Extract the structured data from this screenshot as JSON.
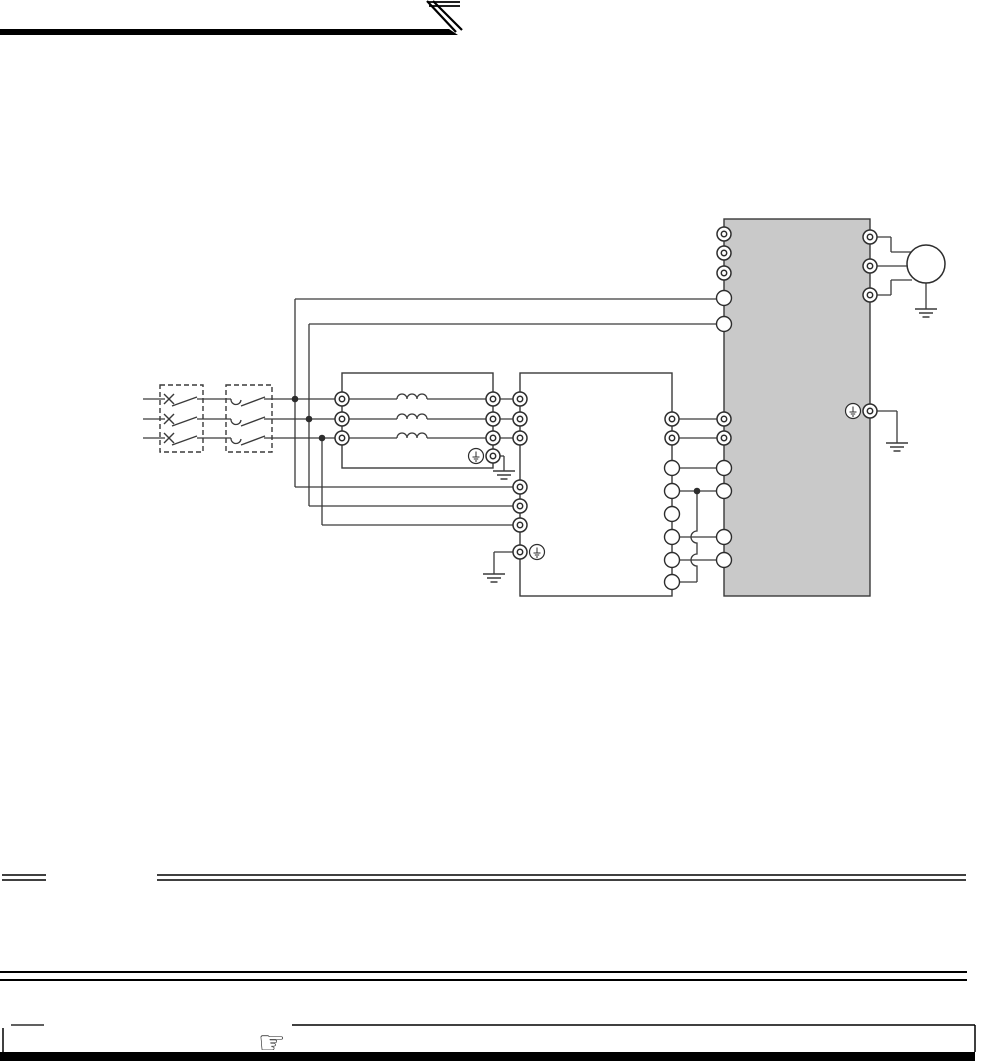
{
  "meta": {
    "description": "Scanned manual page: three-phase inverter wiring diagram (breaker, contactor, AC reactor, noise filter, inverter, motor). No rendered text on page.",
    "page_bg": "#ffffff",
    "ink": "#000000",
    "wire_color": "#3a3a3a",
    "terminal_stroke": "#2d2d2d",
    "inverter_fill": "#c9c9c9",
    "box_fill": "#ffffff"
  },
  "header": {
    "bar_points": "0,29 449,29 458,35 0,35",
    "diagonal_stripes": [
      [
        427,
        1,
        456,
        32
      ],
      [
        433,
        1,
        462,
        30
      ]
    ],
    "top_stripes": [
      [
        428,
        2,
        460,
        2
      ],
      [
        429,
        6,
        460,
        6
      ]
    ]
  },
  "schematic": {
    "phase_ys": [
      399,
      419,
      438
    ],
    "boxes": [
      {
        "name": "circuit-breaker-box",
        "dashed": true,
        "x": 160,
        "y": 385,
        "w": 43,
        "h": 67
      },
      {
        "name": "magnetic-contactor-box",
        "dashed": true,
        "x": 226,
        "y": 385,
        "w": 46,
        "h": 67
      },
      {
        "name": "ac-reactor-box",
        "dashed": false,
        "x": 342,
        "y": 373,
        "w": 151,
        "h": 95,
        "fill": "#ffffff"
      },
      {
        "name": "noise-filter-box",
        "dashed": false,
        "x": 520,
        "y": 373,
        "w": 152,
        "h": 223,
        "fill": "#ffffff"
      },
      {
        "name": "inverter-box",
        "dashed": false,
        "x": 724,
        "y": 219,
        "w": 146,
        "h": 377,
        "fill": "#c9c9c9"
      }
    ],
    "wires": [
      [
        143,
        399,
        165,
        399
      ],
      [
        197,
        399,
        231,
        399
      ],
      [
        264,
        399,
        342,
        399
      ],
      [
        342,
        399,
        397,
        399
      ],
      [
        427,
        399,
        493,
        399
      ],
      [
        493,
        399,
        520,
        399
      ],
      [
        143,
        419,
        165,
        419
      ],
      [
        197,
        419,
        231,
        419
      ],
      [
        264,
        419,
        342,
        419
      ],
      [
        342,
        419,
        397,
        419
      ],
      [
        427,
        419,
        493,
        419
      ],
      [
        493,
        419,
        520,
        419
      ],
      [
        143,
        438,
        165,
        438
      ],
      [
        197,
        438,
        231,
        438
      ],
      [
        264,
        438,
        342,
        438
      ],
      [
        342,
        438,
        397,
        438
      ],
      [
        427,
        438,
        493,
        438
      ],
      [
        493,
        438,
        520,
        438
      ],
      [
        295,
        299,
        724,
        299
      ],
      [
        309,
        324,
        724,
        324
      ],
      [
        295,
        299,
        295,
        487
      ],
      [
        295,
        487,
        520,
        487
      ],
      [
        309,
        324,
        309,
        506
      ],
      [
        309,
        506,
        520,
        506
      ],
      [
        322,
        438,
        322,
        525
      ],
      [
        322,
        525,
        520,
        525
      ],
      [
        672,
        419,
        724,
        419
      ],
      [
        672,
        438,
        724,
        438
      ],
      [
        672,
        468,
        724,
        468
      ],
      [
        672,
        491,
        724,
        491
      ],
      [
        672,
        537,
        724,
        537
      ],
      [
        672,
        560,
        724,
        560
      ],
      [
        672,
        582,
        697,
        582
      ],
      [
        870,
        237,
        891,
        237
      ],
      [
        891,
        237,
        891,
        252
      ],
      [
        891,
        252,
        912,
        252
      ],
      [
        870,
        266,
        912,
        266
      ],
      [
        870,
        295,
        891,
        295
      ],
      [
        891,
        295,
        891,
        280
      ],
      [
        891,
        280,
        912,
        280
      ],
      [
        926,
        283,
        926,
        309
      ],
      [
        493,
        456,
        504,
        456
      ],
      [
        504,
        456,
        504,
        471
      ],
      [
        520,
        552,
        494,
        552
      ],
      [
        494,
        552,
        494,
        574
      ],
      [
        870,
        411,
        897,
        411
      ],
      [
        897,
        411,
        897,
        443
      ]
    ],
    "blades": [
      [
        172,
        406,
        197,
        397
      ],
      [
        172,
        426,
        197,
        417
      ],
      [
        172,
        445,
        197,
        436
      ],
      [
        241,
        406,
        265,
        397
      ],
      [
        241,
        426,
        265,
        417
      ],
      [
        241,
        445,
        265,
        436
      ]
    ],
    "x_contacts": [
      [
        169,
        399
      ],
      [
        169,
        419
      ],
      [
        169,
        438
      ]
    ],
    "cup_contacts": [
      [
        236,
        399
      ],
      [
        236,
        419
      ],
      [
        236,
        438
      ]
    ],
    "coils": [
      [
        397,
        399
      ],
      [
        397,
        419
      ],
      [
        397,
        438
      ]
    ],
    "hop_link": {
      "x": 697,
      "y1": 491,
      "y2": 582,
      "hops": [
        537,
        560
      ],
      "r": 6
    },
    "dots": [
      [
        295,
        399
      ],
      [
        309,
        419
      ],
      [
        322,
        438
      ],
      [
        697,
        491
      ]
    ],
    "terminals": [
      [
        342,
        399,
        "d"
      ],
      [
        342,
        419,
        "d"
      ],
      [
        342,
        438,
        "d"
      ],
      [
        493,
        399,
        "d"
      ],
      [
        493,
        419,
        "d"
      ],
      [
        493,
        438,
        "d"
      ],
      [
        493,
        456,
        "d"
      ],
      [
        520,
        399,
        "d"
      ],
      [
        520,
        419,
        "d"
      ],
      [
        520,
        438,
        "d"
      ],
      [
        520,
        487,
        "d"
      ],
      [
        520,
        506,
        "d"
      ],
      [
        520,
        525,
        "d"
      ],
      [
        520,
        552,
        "d"
      ],
      [
        672,
        419,
        "d"
      ],
      [
        672,
        438,
        "d"
      ],
      [
        672,
        468,
        "p"
      ],
      [
        672,
        491,
        "p"
      ],
      [
        672,
        514,
        "p"
      ],
      [
        672,
        537,
        "p"
      ],
      [
        672,
        560,
        "p"
      ],
      [
        672,
        582,
        "p"
      ],
      [
        724,
        234,
        "d"
      ],
      [
        724,
        253,
        "d"
      ],
      [
        724,
        273,
        "d"
      ],
      [
        724,
        298,
        "p"
      ],
      [
        724,
        324,
        "p"
      ],
      [
        724,
        419,
        "d"
      ],
      [
        724,
        438,
        "d"
      ],
      [
        724,
        468,
        "p"
      ],
      [
        724,
        491,
        "p"
      ],
      [
        724,
        537,
        "p"
      ],
      [
        724,
        560,
        "p"
      ],
      [
        870,
        237,
        "d"
      ],
      [
        870,
        266,
        "d"
      ],
      [
        870,
        295,
        "d"
      ],
      [
        870,
        411,
        "d"
      ]
    ],
    "ground_icons": [
      [
        476,
        456
      ],
      [
        537,
        552
      ],
      [
        853,
        411
      ]
    ],
    "earths": [
      [
        504,
        471
      ],
      [
        494,
        574
      ],
      [
        897,
        443
      ],
      [
        926,
        309
      ]
    ],
    "motor": {
      "cx": 926,
      "cy": 264,
      "r": 19
    }
  },
  "rules": [
    {
      "name": "section-rule-left",
      "x1": 2,
      "x2": 46,
      "ys": [
        875,
        880
      ],
      "w": 1.5
    },
    {
      "name": "section-rule-right",
      "x1": 157,
      "x2": 966,
      "ys": [
        875,
        880
      ],
      "w": 1.5
    },
    {
      "name": "full-width-double-rule",
      "x1": 0,
      "x2": 967,
      "ys": [
        972,
        980
      ],
      "w": 2
    }
  ],
  "footer": {
    "top_line_left": [
      11,
      1025,
      44,
      1025
    ],
    "top_line_right": [
      292,
      1025,
      975,
      1025
    ],
    "left_edge": [
      3,
      1028,
      3,
      1052
    ],
    "right_edge": [
      975,
      1025,
      975,
      1052
    ],
    "bottom_bar": {
      "x": 0,
      "y": 1052,
      "w": 975,
      "h": 9
    },
    "hand_glyph": "☞"
  }
}
